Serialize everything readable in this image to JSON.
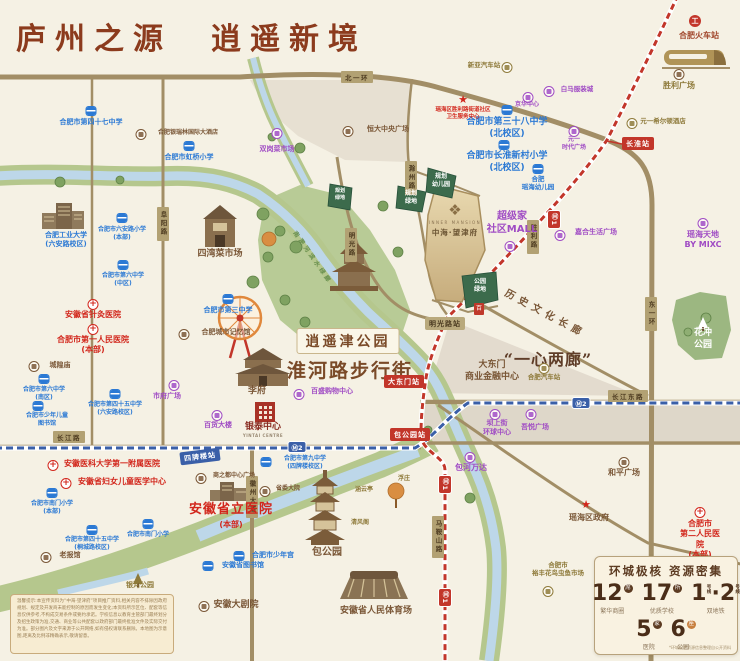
{
  "title": "庐州之源　逍遥新境",
  "site": {
    "en": "INNER MANSION",
    "name": "中海·望津府",
    "badge": "百"
  },
  "roads": {
    "beiyihuan": "北一环",
    "dongyihuan": "东一环",
    "fuyanglu": "阜阳路",
    "mingguanglu": "明光路",
    "chuzhoulu": "滁州路",
    "shenglilu": "胜利路",
    "changjianglu": "长江路",
    "changjiangdonglu": "长江东路",
    "huizhoudadao": "徽州大道",
    "maanshanlu": "马鞍山路"
  },
  "stations": {
    "changhuai": "长淮站",
    "mingguanglu": "明光路站",
    "dadongmen": "大东门站",
    "baogongyuan": "包公园站",
    "sipailou": "四牌楼站"
  },
  "metro": {
    "m1": "Ⓜ1",
    "m2": "Ⓜ2"
  },
  "corridors": {
    "history": "历史文化长廊",
    "waterfront": "南淝河滨水绿廊",
    "yixin": "“一心两廊”",
    "dadongmen_biz": "大东门\n商业金融中心"
  },
  "parks": {
    "xiaoyaojin": "逍遥津公园",
    "huaihe": "淮河路步行街",
    "huachong": "花冲\n公园",
    "baogongyuan": "包公园",
    "yinhe": "银河公园",
    "qingfengge": "清风阁",
    "fuzhuang": "浮庄",
    "hanyunting": "涵云亭",
    "lvdi1": "规划\n绿地",
    "lvdi2": "规划\n绿地",
    "youeryuan": "规划\n幼儿园",
    "gongyuanlvdi": "公园\n绿地"
  },
  "schools": {
    "s47": "合肥市第四十七中学",
    "hongqiao": "合肥市虹桥小学",
    "hfut": "合肥工业大学\n(六安路校区)",
    "luanlu": "合肥市六安路小学\n(本部)",
    "six_n": "合肥市第六中学\n(中区)",
    "six_s": "合肥市第六中学\n(南区)",
    "no3": "合肥市第三中学",
    "no45_n": "合肥市第四十五中学\n(六安路校区)",
    "no45_s": "合肥市第四十五中学\n(桐城路校区)",
    "kidslib": "合肥市少年儿童\n图书馆",
    "no38": "合肥市第三十八中学\n(北校区)",
    "changhuai_p": "合肥市长淮新村小学\n(北校区)",
    "yaohai_kg": "合肥\n瑶海幼儿园",
    "nanmen_n": "合肥市南门小学\n(本部)",
    "nanmen_s": "合肥市南门小学",
    "no9": "合肥市第九中学\n(四牌楼校区)",
    "shaoniangong": "合肥市少年宫",
    "ahlib": "安徽省图书馆"
  },
  "hospitals": {
    "zhenjiu": "安徽省针灸医院",
    "first": "合肥市第一人民医院\n(本部)",
    "anyi": "安徽医科大学第一附属医院",
    "fuyou": "安徽省妇女儿童医学中心",
    "shengli": "安徽省立医院",
    "shengli_sub": "(本部)",
    "second": "合肥市\n第二人民医院\n(本部)",
    "weisheng": "瑶海区胜利路街道社区\n卫生服务中心"
  },
  "places": {
    "shuanggang": "双岗菜市场",
    "siwan": "四湾菜市场",
    "shifu": "市府广场",
    "baihuo": "百货大楼",
    "baisheng": "百盛购物中心",
    "yintai": "银泰中心",
    "yintai_en": "YINTAI CENTRE",
    "chaojijia": "超级家\n社区MALL",
    "jiahe": "嘉合生活广场",
    "yaohai_td": "瑶海天地\nBY MIXC",
    "bashangjie": "坝上街\n环球中心",
    "wuyue": "吾悦广场",
    "wanda": "包河万达",
    "yuanyi": "元一\n时代广场",
    "baima": "白马服装城",
    "jinghua": "京华中心",
    "hengda": "恒大中央广场",
    "jiyiguan": "合肥城市记忆馆",
    "chenghuang": "城隍庙",
    "shengli_sq": "胜利广场",
    "hilton": "元一希尔顿酒店",
    "laobao": "老报馆",
    "shangzhidu": "商之都中心广场",
    "shengwei": "省委大院",
    "heping": "和平广场",
    "yaohai_gov": "瑶海区政府",
    "dajuyuan": "安徽大剧院",
    "tiyuchang": "安徽省人民体育场",
    "lifu": "李府",
    "yufeng": "合肥市\n裕丰花鸟虫鱼市场",
    "yinruilin": "合肥银瑞林国际大酒店",
    "railstation": "合肥火车站",
    "xinya": "新亚汽车站",
    "hfbus": "合肥汽车站"
  },
  "stats": {
    "title": "环城极核 资源密集",
    "i1": {
      "num": "12",
      "unit": "席",
      "label": "繁华商圈"
    },
    "i2": {
      "num": "17",
      "unit": "所",
      "label": "优质学校"
    },
    "metro_item": {
      "n1": "1",
      "n2": "2",
      "unit": "号线",
      "dot": "·",
      "label": "双地铁"
    },
    "i4": {
      "num": "5",
      "unit": "家",
      "label": "医院"
    },
    "i5": {
      "num": "6",
      "unit": "座",
      "label": "公园"
    },
    "footnote": "*环城配套资源信息整理自公开资料"
  },
  "disclaimer": "温馨提示:本宣传资料为“中海·望津府”项目推广资料,相关内容不排除因政府规划、规定及开发商未能控制的原因而发生变化;本资料所示区位、配套等信息仅供参考,不构成交易条件或要约承诺。学校信息以教育主管部门最终划分及招生政策为准,交通、商业等公共配套以政府部门最终批准文件及实际交付为准。部分图片及文字来源于公开网络,如有侵权请联系删除。本地图为示意图,距离及比例非精确表示,敬请留意。"
}
